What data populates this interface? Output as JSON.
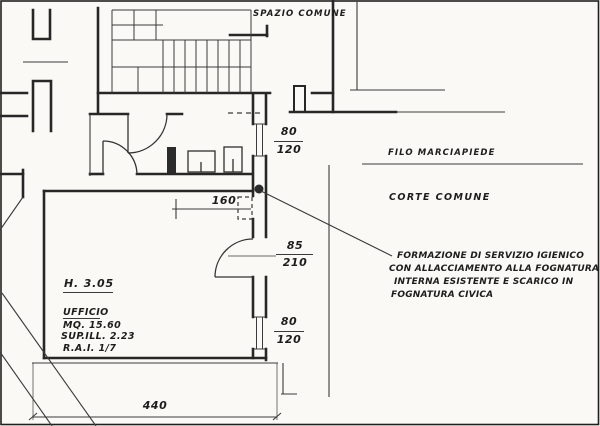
{
  "labels": {
    "spazio_comune": "SPAZIO COMUNE",
    "filo_marciapiede": "FILO MARCIAPIEDE",
    "corte_comune": "CORTE COMUNE"
  },
  "room": {
    "height_label": "H. 3.05",
    "name": "UFFICIO",
    "area": "MQ. 15.60",
    "sup_ill": "SUP.ILL. 2.23",
    "rai": "R.A.I. 1/7"
  },
  "dimensions": {
    "upper_window": {
      "width": "80",
      "height": "120"
    },
    "door": {
      "width": "85",
      "height": "210"
    },
    "lower_window": {
      "width": "80",
      "height": "120"
    },
    "recess_width": "160",
    "room_width": "440"
  },
  "annotation": {
    "line1": "FORMAZIONE DI SERVIZIO IGIENICO",
    "line2": "CON ALLACCIAMENTO  ALLA FOGNATURA",
    "line3": "INTERNA ESISTENTE E SCARICO IN",
    "line4": "FOGNATURA CIVICA"
  },
  "colors": {
    "ink": "#2a2a2a",
    "paper": "#faf9f5"
  }
}
